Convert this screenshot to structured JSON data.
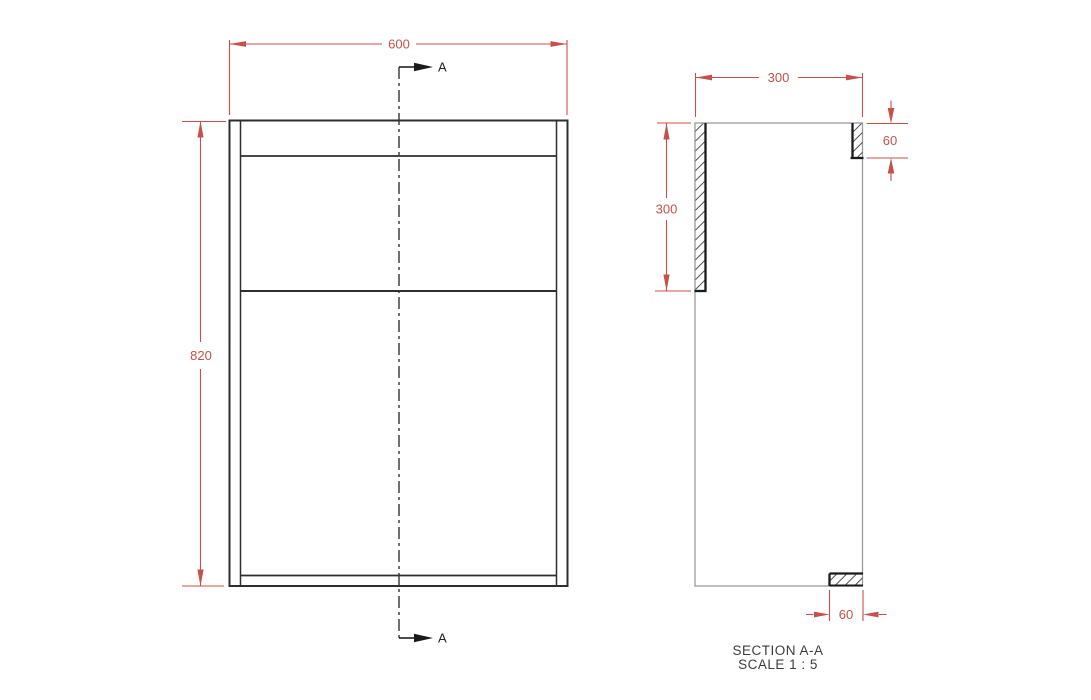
{
  "front_view": {
    "width_label": "600",
    "height_label": "820"
  },
  "section_marker": {
    "top_label": "A",
    "bottom_label": "A"
  },
  "section_view": {
    "depth_label": "300",
    "cut_length_label": "300",
    "top_thickness_label": "60",
    "bottom_depth_label": "60",
    "title": "SECTION A-A",
    "scale_note": "SCALE 1 : 5"
  },
  "colors": {
    "dimension_red": "#c6504a",
    "edge_dark": "#2e2e2e",
    "cut_edge_bold": "#1a1a1a",
    "visible_edge_gray": "#9a9a9a",
    "hatch_line": "#4f4f4f",
    "background": "#ffffff",
    "annotation_black": "#222222",
    "title_gray": "#3d3d3d"
  }
}
